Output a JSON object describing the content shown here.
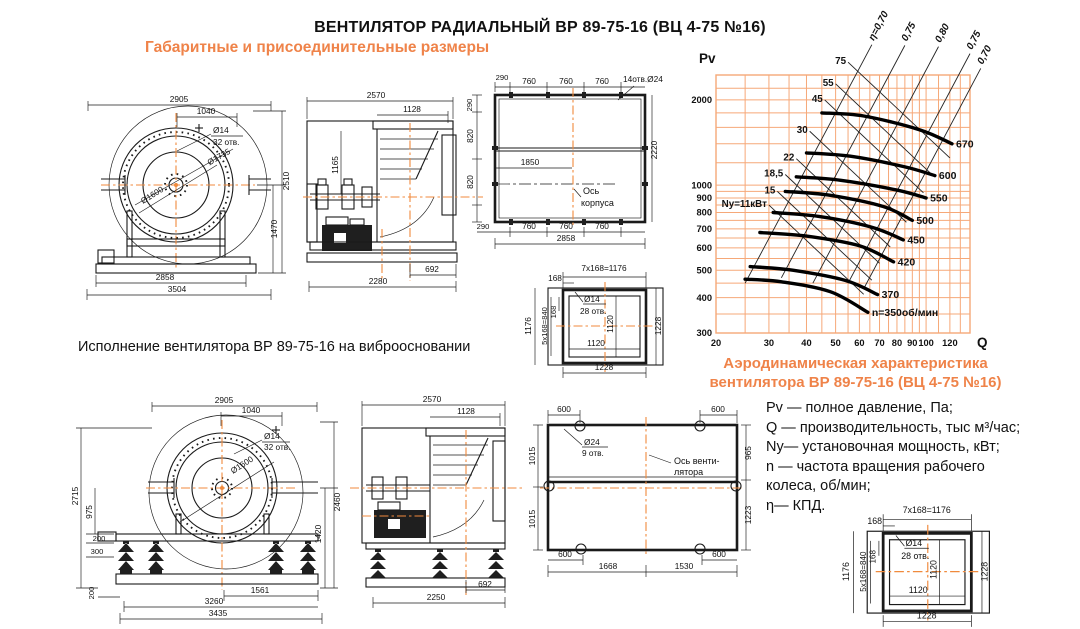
{
  "page": {
    "title": "ВЕНТИЛЯТОР РАДИАЛЬНЫЙ ВР 89-75-16 (ВЦ 4-75 №16)",
    "subtitle_dimensions": "Габаритные и присоединительные размеры",
    "caption_vibro": "Исполнение вентилятора ВР 89-75-16 на виброосновании",
    "chart_caption_line1": "Аэродинамическая характеристика",
    "chart_caption_line2": "вентилятора  ВР 89-75-16 (ВЦ 4-75 №16)",
    "legend": {
      "l1": "Pv — полное давление, Па;",
      "l2": "Q  — производительность, тыс м³/час;",
      "l3": "Ny— установочная мощность, кВт;",
      "l4": "n — частота вращения рабочего",
      "l5": "колеса,  об/мин;",
      "l6": "η— КПД."
    }
  },
  "colors": {
    "accent_orange": "#EF8349",
    "grid_orange": "#F6A878",
    "centerline_orange": "#F08A3C",
    "line_black": "#1a1a1a"
  },
  "drawings": {
    "front_view": {
      "dims": {
        "width_top": "2905",
        "inlet_offset": "1040",
        "hole_dia": "Ø14",
        "hole_count": "32 отв.",
        "flange_dia": "Ø1735",
        "impeller_dia": "Ø1600",
        "height_total": "2510",
        "height_axis": "1470",
        "base_width": "2858",
        "width_total": "3504"
      }
    },
    "side_view": {
      "dims": {
        "width_top": "2570",
        "outlet_width": "1128",
        "shaft_height": "1165",
        "outlet_offset": "692",
        "base_width": "2280"
      }
    },
    "base_plan": {
      "dims": {
        "edge_top": "290",
        "pitch1": "760",
        "pitch2": "760",
        "pitch3": "760",
        "holes": "14отв.Ø24",
        "edge_left": "290",
        "pitch_l1": "820",
        "pitch_l2": "820",
        "edge_bottom": "290",
        "depth_total": "2220",
        "axis_offset": "1850",
        "axis_caption_1": "Ось",
        "axis_caption_2": "корпуса",
        "pitch_b1": "760",
        "pitch_b2": "760",
        "pitch_b3": "760",
        "width_total": "2858"
      }
    },
    "outlet_flange": {
      "dims": {
        "pitch": "168",
        "pitch_row": "7x168=1176",
        "col_total": "1176",
        "pitch_col": "5x168=840",
        "pitch_v": "168",
        "hole_dia": "Ø14",
        "hole_count": "28 отв.",
        "inner_v": "1120",
        "inner_h": "1120",
        "outer_v": "1228",
        "outer_h": "1228"
      }
    },
    "front_view_vibro": {
      "dims": {
        "width_top": "2905",
        "inlet_offset": "1040",
        "hole_dia": "Ø14",
        "hole_count": "32 отв.",
        "impeller_dia": "Ø1600",
        "height_total": "2715",
        "axis_to_frame": "975",
        "h200a": "200",
        "h300": "300",
        "h200b": "200",
        "height_right": "2460",
        "height_axis": "1420",
        "base_inner": "1561",
        "base_mid": "3260",
        "base_total": "3435"
      }
    },
    "side_view_vibro": {
      "dims": {
        "width_top": "2570",
        "outlet_width": "1128",
        "outlet_offset": "692",
        "base_width": "2250"
      }
    },
    "vibro_base_plan": {
      "dims": {
        "t600l": "600",
        "t600r": "600",
        "l1015a": "1015",
        "l1015b": "1015",
        "r965": "965",
        "r1223": "1223",
        "hole_dia": "Ø24",
        "hole_count": "9 отв.",
        "axis_caption_1": "Ось венти-",
        "axis_caption_2": "лятора",
        "b600l": "600",
        "b1668": "1668",
        "b1530": "1530",
        "b600r": "600"
      }
    },
    "outlet_flange_2": {
      "dims": {
        "pitch": "168",
        "pitch_row": "7x168=1176",
        "col_total": "1176",
        "pitch_col": "5x168=840",
        "pitch_v": "168",
        "hole_dia": "Ø14",
        "hole_count": "28 отв.",
        "inner_v": "1120",
        "inner_h": "1120",
        "outer_v": "1228",
        "outer_h": "1228"
      }
    }
  },
  "chart_data": {
    "type": "line",
    "title": "Аэродинамическая характеристика вентилятора ВР 89-75-16 (ВЦ 4-75 №16)",
    "xlabel": "Q",
    "ylabel": "Pv",
    "x_unit": "тыс м³/час",
    "y_unit": "Па",
    "x_scale": "log",
    "y_scale": "log",
    "xlim": [
      20,
      140
    ],
    "ylim": [
      300,
      2450
    ],
    "x_ticks": [
      20,
      30,
      40,
      50,
      60,
      70,
      80,
      90,
      100,
      120
    ],
    "x_minor": [
      25,
      35,
      45,
      55,
      65,
      75,
      85,
      95,
      110,
      130,
      140
    ],
    "y_ticks": [
      300,
      400,
      500,
      600,
      700,
      800,
      900,
      1000,
      2000
    ],
    "y_minor": [
      350,
      450,
      550,
      650,
      750,
      850,
      950,
      1200,
      1400,
      1600,
      1800,
      2200
    ],
    "grid": true,
    "legend_position": "none",
    "rpm_curves": [
      {
        "label": "n=350об/мин",
        "rpm": 350,
        "points": [
          [
            25,
            465
          ],
          [
            33,
            455
          ],
          [
            48,
            420
          ],
          [
            64,
            355
          ]
        ]
      },
      {
        "label": "370",
        "rpm": 370,
        "points": [
          [
            26,
            515
          ],
          [
            36,
            500
          ],
          [
            54,
            460
          ],
          [
            69,
            410
          ]
        ]
      },
      {
        "label": "420",
        "rpm": 420,
        "points": [
          [
            28,
            680
          ],
          [
            40,
            660
          ],
          [
            60,
            610
          ],
          [
            78,
            535
          ]
        ]
      },
      {
        "label": "450",
        "rpm": 450,
        "points": [
          [
            31,
            800
          ],
          [
            44,
            775
          ],
          [
            66,
            710
          ],
          [
            84,
            640
          ]
        ]
      },
      {
        "label": "500",
        "rpm": 500,
        "points": [
          [
            34,
            950
          ],
          [
            48,
            920
          ],
          [
            72,
            840
          ],
          [
            90,
            750
          ]
        ]
      },
      {
        "label": "550",
        "rpm": 550,
        "points": [
          [
            37,
            1070
          ],
          [
            52,
            1040
          ],
          [
            80,
            960
          ],
          [
            100,
            900
          ]
        ]
      },
      {
        "label": "600",
        "rpm": 600,
        "points": [
          [
            40,
            1300
          ],
          [
            56,
            1265
          ],
          [
            85,
            1160
          ],
          [
            107,
            1080
          ]
        ]
      },
      {
        "label": "670",
        "rpm": 670,
        "points": [
          [
            45,
            1800
          ],
          [
            62,
            1755
          ],
          [
            95,
            1570
          ],
          [
            122,
            1400
          ]
        ]
      }
    ],
    "power_lines": [
      {
        "label": "Ny=11кВт",
        "kw": 11,
        "from": [
          30,
          850
        ],
        "to": [
          62,
          411
        ]
      },
      {
        "label": "15",
        "kw": 15,
        "from": [
          32,
          950
        ],
        "to": [
          66,
          461
        ]
      },
      {
        "label": "18,5",
        "kw": 18.5,
        "from": [
          34,
          1090
        ],
        "to": [
          70,
          529
        ]
      },
      {
        "label": "22",
        "kw": 22,
        "from": [
          37,
          1240
        ],
        "to": [
          76,
          604
        ]
      },
      {
        "label": "30",
        "kw": 30,
        "from": [
          41,
          1550
        ],
        "to": [
          86,
          739
        ]
      },
      {
        "label": "45",
        "kw": 45,
        "from": [
          46,
          2000
        ],
        "to": [
          98,
          939
        ]
      },
      {
        "label": "55",
        "kw": 55,
        "from": [
          50,
          2280
        ],
        "to": [
          106,
          1075
        ]
      },
      {
        "label": "75",
        "kw": 75,
        "from": [
          55,
          2720
        ],
        "to": [
          120,
          1247
        ]
      }
    ],
    "efficiency_lines": [
      {
        "label": "η=0,70",
        "eta": 0.7,
        "from": [
          25,
          450
        ],
        "to": [
          66,
          3136
        ]
      },
      {
        "label": "0,75",
        "eta": 0.75,
        "from": [
          33,
          470
        ],
        "to": [
          85,
          3118
        ]
      },
      {
        "label": "0,80",
        "eta": 0.8,
        "from": [
          42,
          450
        ],
        "to": [
          110,
          3086
        ]
      },
      {
        "label": "0,75",
        "eta": 0.75,
        "from": [
          55,
          450
        ],
        "to": [
          140,
          2916
        ]
      },
      {
        "label": "0,70",
        "eta": 0.7,
        "from": [
          62,
          430
        ],
        "to": [
          152,
          2584
        ]
      }
    ]
  }
}
